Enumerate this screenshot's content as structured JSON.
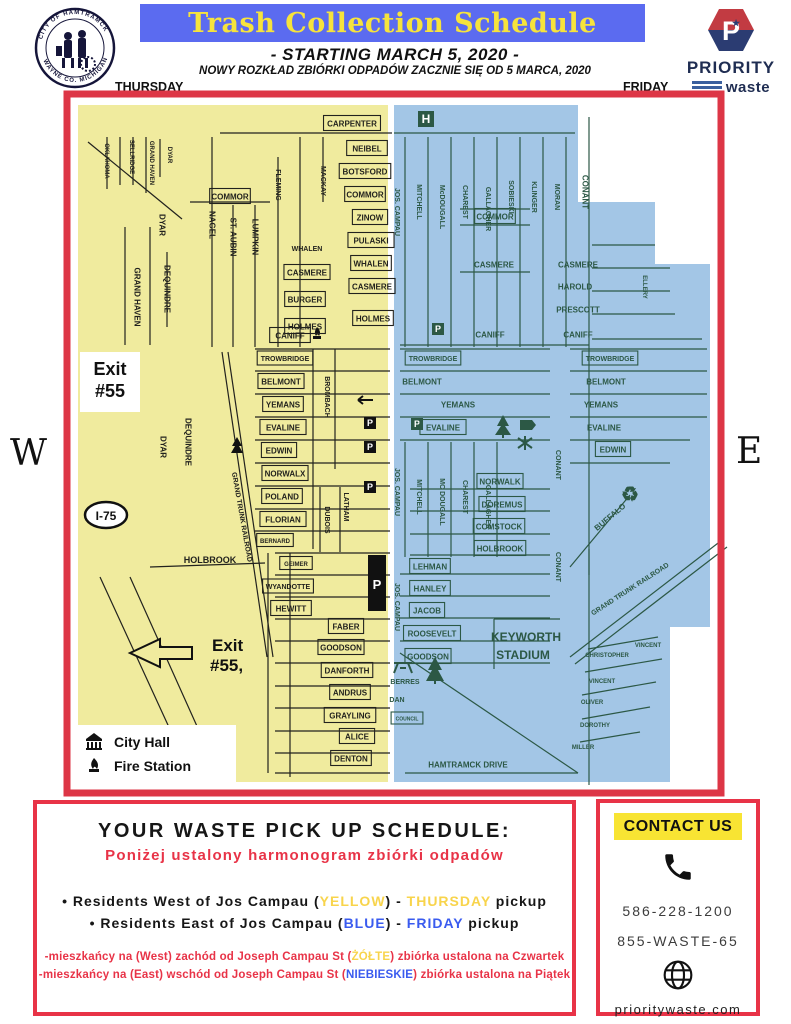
{
  "header": {
    "title": "Trash Collection Schedule",
    "title_bg": "#5b6bf0",
    "title_color": "#f6e33c",
    "subtitle": "- STARTING MARCH 5, 2020 -",
    "subtitle_pl": "NOWY ROZKŁAD ZBIÓRKI ODPADÓW ZACZNIE SIĘ OD 5 MARCA, 2020",
    "left_day": "THURSDAY",
    "right_day": "FRIDAY",
    "seal_top": "CITY OF HAMTRAMCK",
    "seal_bottom": "WAYNE CO. MICHIGAN",
    "logo": {
      "p": "P",
      "star": "★",
      "name": "PRIORITY",
      "sub": "waste",
      "red": "#c23b42",
      "navy": "#2b3c72"
    }
  },
  "map": {
    "west_label": "W",
    "east_label": "E",
    "yellow": "#f0eb9e",
    "blue": "#a3c6e6",
    "frame_red": "#dd3646",
    "line_west": "#22221e",
    "line_east": "#2c5845",
    "icons": {
      "hospital": "H",
      "parking": "P",
      "recycle": "♻"
    },
    "exit1a": "Exit",
    "exit1b": "#55",
    "exit2a": "Exit",
    "exit2b": "#55,",
    "highway": "I-75",
    "legend": [
      {
        "icon": "city-hall-icon",
        "label": "City Hall"
      },
      {
        "icon": "fire-station-icon",
        "label": "Fire Station"
      }
    ],
    "labels": [
      {
        "t": "CARPENTER",
        "x": 282,
        "y": 27,
        "s": "w",
        "b": 1
      },
      {
        "t": "OKLAHOMA",
        "x": 37,
        "y": 64,
        "r": 90,
        "s": "w",
        "f": 6
      },
      {
        "t": "SELLRIDGE",
        "x": 62,
        "y": 60,
        "r": 90,
        "s": "w",
        "f": 6
      },
      {
        "t": "GRAND HAVEN",
        "x": 82,
        "y": 66,
        "r": 90,
        "s": "w",
        "f": 6
      },
      {
        "t": "DYAR",
        "x": 100,
        "y": 58,
        "r": 90,
        "s": "w",
        "f": 6
      },
      {
        "t": "COMMOR",
        "x": 160,
        "y": 100,
        "s": "w",
        "b": 1
      },
      {
        "t": "NAGEL",
        "x": 142,
        "y": 128,
        "r": 90,
        "s": "w"
      },
      {
        "t": "ST. AUBIN",
        "x": 163,
        "y": 140,
        "r": 90,
        "s": "w"
      },
      {
        "t": "LUMPKIN",
        "x": 185,
        "y": 140,
        "r": 90,
        "s": "w"
      },
      {
        "t": "FLEMING",
        "x": 208,
        "y": 88,
        "r": 90,
        "s": "w",
        "f": 7
      },
      {
        "t": "MACKAY",
        "x": 253,
        "y": 84,
        "r": 90,
        "s": "w",
        "f": 7
      },
      {
        "t": "DYAR",
        "x": 92,
        "y": 128,
        "r": 90,
        "s": "w"
      },
      {
        "t": "GRAND HAVEN",
        "x": 67,
        "y": 200,
        "r": 90,
        "s": "w"
      },
      {
        "t": "DEQUINDRE",
        "x": 97,
        "y": 192,
        "r": 90,
        "s": "w"
      },
      {
        "t": "NEIBEL",
        "x": 297,
        "y": 52,
        "s": "w",
        "b": 1
      },
      {
        "t": "BOTSFORD",
        "x": 295,
        "y": 75,
        "s": "w",
        "b": 1
      },
      {
        "t": "COMMOR",
        "x": 295,
        "y": 98,
        "s": "w",
        "b": 1
      },
      {
        "t": "ZINOW",
        "x": 300,
        "y": 121,
        "s": "w",
        "b": 1
      },
      {
        "t": "PULASKI",
        "x": 301,
        "y": 144,
        "s": "w",
        "b": 1
      },
      {
        "t": "WHALEN",
        "x": 237,
        "y": 152,
        "s": "w",
        "f": 7
      },
      {
        "t": "WHALEN",
        "x": 301,
        "y": 167,
        "s": "w",
        "b": 1
      },
      {
        "t": "CASMERE",
        "x": 237,
        "y": 176,
        "s": "w",
        "b": 1
      },
      {
        "t": "CASMERE",
        "x": 302,
        "y": 190,
        "s": "w",
        "b": 1
      },
      {
        "t": "BURGER",
        "x": 235,
        "y": 203,
        "s": "w",
        "b": 1
      },
      {
        "t": "HOLMES",
        "x": 235,
        "y": 230,
        "s": "w",
        "b": 1
      },
      {
        "t": "HOLMES",
        "x": 303,
        "y": 222,
        "s": "w",
        "b": 1
      },
      {
        "t": "CANIFF",
        "x": 220,
        "y": 239,
        "s": "w",
        "b": 1
      },
      {
        "t": "TROWBRIDGE",
        "x": 215,
        "y": 262,
        "s": "w",
        "f": 7,
        "b": 1
      },
      {
        "t": "BELMONT",
        "x": 211,
        "y": 285,
        "s": "w",
        "b": 1
      },
      {
        "t": "YEMANS",
        "x": 213,
        "y": 308,
        "s": "w",
        "b": 1
      },
      {
        "t": "EVALINE",
        "x": 213,
        "y": 331,
        "s": "w",
        "b": 1
      },
      {
        "t": "EDWIN",
        "x": 209,
        "y": 354,
        "s": "w",
        "b": 1
      },
      {
        "t": "NORWALX",
        "x": 215,
        "y": 377,
        "s": "w",
        "b": 1
      },
      {
        "t": "POLAND",
        "x": 212,
        "y": 400,
        "s": "w",
        "b": 1
      },
      {
        "t": "FLORIAN",
        "x": 213,
        "y": 423,
        "s": "w",
        "b": 1
      },
      {
        "t": "BERNARD",
        "x": 205,
        "y": 444,
        "s": "w",
        "f": 6,
        "b": 1
      },
      {
        "t": "BROMBACH",
        "x": 257,
        "y": 300,
        "r": 90,
        "s": "w",
        "f": 7
      },
      {
        "t": "DUBOIS",
        "x": 257,
        "y": 423,
        "r": 90,
        "s": "w",
        "f": 7
      },
      {
        "t": "LATHAM",
        "x": 276,
        "y": 410,
        "r": 90,
        "s": "w",
        "f": 7
      },
      {
        "t": "DYAR",
        "x": 93,
        "y": 350,
        "r": 90,
        "s": "w"
      },
      {
        "t": "DEQUINDRE",
        "x": 118,
        "y": 345,
        "r": 90,
        "s": "w"
      },
      {
        "t": "GRAND TRUNK RAILROAD",
        "x": 172,
        "y": 420,
        "r": 80,
        "s": "w",
        "f": 7
      },
      {
        "t": "HOLBROOK",
        "x": 140,
        "y": 463,
        "s": "w",
        "f": 9
      },
      {
        "t": "GEIMER",
        "x": 226,
        "y": 467,
        "s": "w",
        "f": 6,
        "b": 1
      },
      {
        "t": "WYANDOTTE",
        "x": 218,
        "y": 490,
        "s": "w",
        "f": 7,
        "b": 1
      },
      {
        "t": "HEWITT",
        "x": 221,
        "y": 512,
        "s": "w",
        "b": 1
      },
      {
        "t": "FABER",
        "x": 276,
        "y": 530,
        "s": "w",
        "b": 1
      },
      {
        "t": "GOODSON",
        "x": 271,
        "y": 551,
        "s": "w",
        "b": 1
      },
      {
        "t": "DANFORTH",
        "x": 277,
        "y": 574,
        "s": "w",
        "b": 1
      },
      {
        "t": "ANDRUS",
        "x": 280,
        "y": 596,
        "s": "w",
        "b": 1
      },
      {
        "t": "GRAYLING",
        "x": 280,
        "y": 619,
        "s": "w",
        "b": 1
      },
      {
        "t": "ALICE",
        "x": 287,
        "y": 640,
        "s": "w",
        "b": 1
      },
      {
        "t": "DENTON",
        "x": 281,
        "y": 662,
        "s": "w",
        "b": 1
      },
      {
        "t": "JOS. CAMPAU",
        "x": 327,
        "y": 115,
        "r": 90,
        "s": "e",
        "f": 7
      },
      {
        "t": "JOS. CAMPAU",
        "x": 327,
        "y": 395,
        "r": 90,
        "s": "e",
        "f": 7
      },
      {
        "t": "JOS. CAMPAU",
        "x": 327,
        "y": 510,
        "r": 90,
        "s": "e",
        "f": 7
      },
      {
        "t": "MITCHELL",
        "x": 349,
        "y": 105,
        "r": 90,
        "s": "e",
        "f": 7
      },
      {
        "t": "McDOUGALL",
        "x": 372,
        "y": 110,
        "r": 90,
        "s": "e",
        "f": 7
      },
      {
        "t": "CHAREST",
        "x": 395,
        "y": 105,
        "r": 90,
        "s": "e",
        "f": 7
      },
      {
        "t": "GALLAGHER",
        "x": 418,
        "y": 112,
        "r": 90,
        "s": "e",
        "f": 7
      },
      {
        "t": "SOBIESKI",
        "x": 441,
        "y": 100,
        "r": 90,
        "s": "e",
        "f": 7
      },
      {
        "t": "KLINGER",
        "x": 464,
        "y": 100,
        "r": 90,
        "s": "e",
        "f": 7
      },
      {
        "t": "MORAN",
        "x": 487,
        "y": 100,
        "r": 90,
        "s": "e",
        "f": 7
      },
      {
        "t": "CONANT",
        "x": 515,
        "y": 95,
        "r": 90,
        "s": "e"
      },
      {
        "t": "ELLERY",
        "x": 575,
        "y": 190,
        "r": 90,
        "s": "e",
        "f": 6
      },
      {
        "t": "COMMOR",
        "x": 425,
        "y": 120,
        "s": "e",
        "b": 1
      },
      {
        "t": "CASMERE",
        "x": 424,
        "y": 168,
        "s": "e"
      },
      {
        "t": "CASMERE",
        "x": 508,
        "y": 168,
        "s": "e"
      },
      {
        "t": "HAROLD",
        "x": 505,
        "y": 190,
        "s": "e"
      },
      {
        "t": "PRESCOTT",
        "x": 508,
        "y": 213,
        "s": "e"
      },
      {
        "t": "CANIFF",
        "x": 508,
        "y": 238,
        "s": "e"
      },
      {
        "t": "CANIFF",
        "x": 420,
        "y": 238,
        "s": "e"
      },
      {
        "t": "TROWBRIDGE",
        "x": 363,
        "y": 262,
        "s": "e",
        "f": 7,
        "b": 1
      },
      {
        "t": "BELMONT",
        "x": 352,
        "y": 285,
        "s": "e"
      },
      {
        "t": "YEMANS",
        "x": 388,
        "y": 308,
        "s": "e"
      },
      {
        "t": "EVALINE",
        "x": 373,
        "y": 331,
        "s": "e",
        "b": 1
      },
      {
        "t": "TROWBRIDGE",
        "x": 540,
        "y": 262,
        "s": "e",
        "f": 7,
        "b": 1
      },
      {
        "t": "BELMONT",
        "x": 536,
        "y": 285,
        "s": "e"
      },
      {
        "t": "YEMANS",
        "x": 531,
        "y": 308,
        "s": "e"
      },
      {
        "t": "EVALINE",
        "x": 534,
        "y": 331,
        "s": "e"
      },
      {
        "t": "EDWIN",
        "x": 543,
        "y": 353,
        "s": "e",
        "b": 1
      },
      {
        "t": "MITCHELL",
        "x": 349,
        "y": 400,
        "r": 90,
        "s": "e",
        "f": 7
      },
      {
        "t": "MC DOUGALL",
        "x": 372,
        "y": 405,
        "r": 90,
        "s": "e",
        "f": 7
      },
      {
        "t": "CHAREST",
        "x": 395,
        "y": 400,
        "r": 90,
        "s": "e",
        "f": 7
      },
      {
        "t": "GALLAGHER",
        "x": 418,
        "y": 410,
        "r": 90,
        "s": "e",
        "f": 7
      },
      {
        "t": "CONANT",
        "x": 488,
        "y": 368,
        "r": 90,
        "s": "e",
        "f": 7
      },
      {
        "t": "NORWALK",
        "x": 430,
        "y": 385,
        "s": "e",
        "b": 1
      },
      {
        "t": "DOREMUS",
        "x": 432,
        "y": 408,
        "s": "e",
        "b": 1
      },
      {
        "t": "COMSTOCK",
        "x": 429,
        "y": 430,
        "s": "e",
        "b": 1
      },
      {
        "t": "HOLBROOK",
        "x": 430,
        "y": 452,
        "s": "e",
        "b": 1
      },
      {
        "t": "BUFFALO",
        "x": 540,
        "y": 420,
        "r": -40,
        "s": "e"
      },
      {
        "t": "CONANT",
        "x": 488,
        "y": 470,
        "r": 90,
        "s": "e",
        "f": 7
      },
      {
        "t": "LEHMAN",
        "x": 360,
        "y": 470,
        "s": "e",
        "b": 1
      },
      {
        "t": "HANLEY",
        "x": 360,
        "y": 492,
        "s": "e",
        "b": 1
      },
      {
        "t": "JACOB",
        "x": 357,
        "y": 514,
        "s": "e",
        "b": 1
      },
      {
        "t": "ROOSEVELT",
        "x": 362,
        "y": 537,
        "s": "e",
        "b": 1
      },
      {
        "t": "GOODSON",
        "x": 358,
        "y": 560,
        "s": "e",
        "b": 1
      },
      {
        "t": "KEYWORTH",
        "x": 456,
        "y": 540,
        "s": "e",
        "f": 12
      },
      {
        "t": "STADIUM",
        "x": 453,
        "y": 558,
        "s": "e",
        "f": 12
      },
      {
        "t": "GRAND TRUNK RAILROAD",
        "x": 560,
        "y": 492,
        "r": -33,
        "s": "e",
        "f": 7
      },
      {
        "t": "VINCENT",
        "x": 578,
        "y": 548,
        "s": "e",
        "f": 6
      },
      {
        "t": "CHRISTOPHER",
        "x": 537,
        "y": 558,
        "s": "e",
        "f": 6
      },
      {
        "t": "VINCENT",
        "x": 532,
        "y": 584,
        "s": "e",
        "f": 6
      },
      {
        "t": "OLIVER",
        "x": 522,
        "y": 605,
        "s": "e",
        "f": 6
      },
      {
        "t": "DOROTHY",
        "x": 525,
        "y": 628,
        "s": "e",
        "f": 6
      },
      {
        "t": "MILLER",
        "x": 513,
        "y": 650,
        "s": "e",
        "f": 6
      },
      {
        "t": "BERRES",
        "x": 335,
        "y": 585,
        "s": "e",
        "f": 7
      },
      {
        "t": "DAN",
        "x": 327,
        "y": 603,
        "s": "e",
        "f": 7
      },
      {
        "t": "COUNCIL",
        "x": 337,
        "y": 622,
        "s": "e",
        "f": 5,
        "b": 1
      },
      {
        "t": "HAMTRAMCK DRIVE",
        "x": 398,
        "y": 668,
        "s": "e"
      }
    ]
  },
  "schedule": {
    "title": "YOUR WASTE PICK UP SCHEDULE:",
    "subtitle_pl": "Poniżej ustalony harmonogram zbiórki odpadów",
    "bullet": "•",
    "bullets": [
      {
        "pre": " Residents West of Jos Campau (",
        "word": "YELLOW",
        "mid": ") - ",
        "day": "THURSDAY",
        "post": " pickup"
      },
      {
        "pre": " Residents East of Jos Campau (",
        "word": "BLUE",
        "mid": ") - ",
        "day": "FRIDAY",
        "post": " pickup"
      }
    ],
    "notes": [
      {
        "pre": "-mieszkańcy na (West) zachód od  Joseph Campau St (",
        "word": "ŻÓŁTE",
        "post": ") zbiórka ustalona na Czwartek"
      },
      {
        "pre": "-mieszkańcy  na (East) wschód od Joseph Campau St (",
        "word": "NIEBIESKIE",
        "post": ") zbiórka ustalona na Piątek"
      }
    ],
    "yellow_hex": "#f8d44c",
    "blue_hex": "#3a5bef",
    "red_hex": "#e83347"
  },
  "contact": {
    "title": "CONTACT US",
    "phone1": "586-228-1200",
    "phone2": "855-WASTE-65",
    "website": "prioritywaste.com"
  }
}
